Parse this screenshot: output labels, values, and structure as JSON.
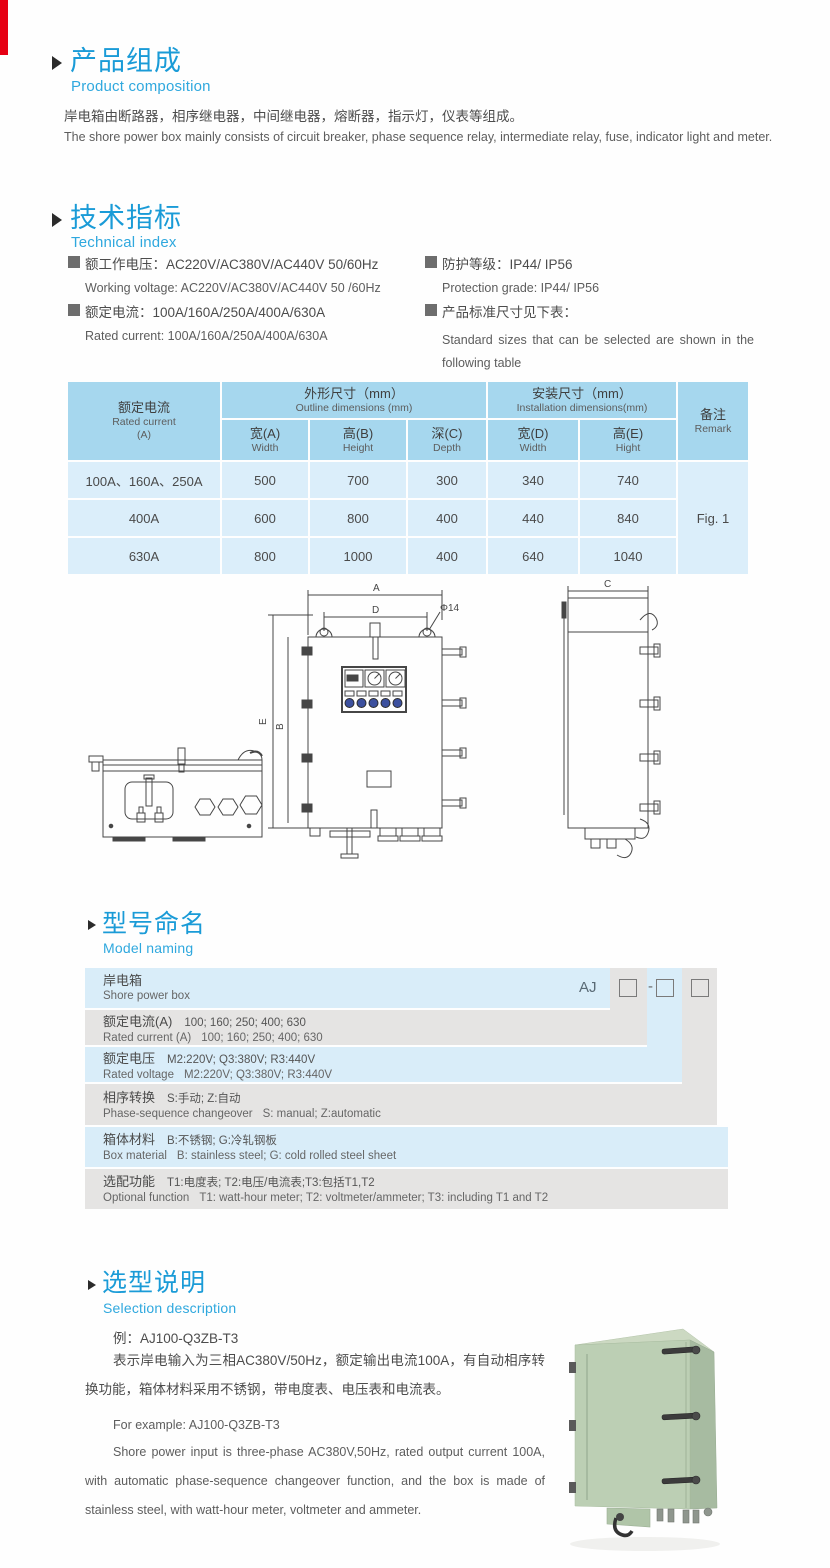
{
  "colors": {
    "accent_blue": "#1a9bd7",
    "subtitle_blue": "#2fa8de",
    "table_header_blue": "#a6d7ee",
    "table_row_blue": "#dbeefa",
    "naming_blue": "#d9edf9",
    "naming_gray": "#e5e4e3",
    "corner_mark_red": "#e60013",
    "lamp_blue": "#3c509e",
    "cabinet_green": "#bccfb4"
  },
  "product_composition": {
    "title_cn": "产品组成",
    "title_en": "Product composition",
    "body_cn": "岸电箱由断路器，相序继电器，中间继电器，熔断器，指示灯，仪表等组成。",
    "body_en": "The shore power box mainly consists of circuit breaker, phase sequence relay, intermediate relay, fuse, indicator light and meter."
  },
  "technical_index": {
    "title_cn": "技术指标",
    "title_en": "Technical index",
    "specs": [
      {
        "cn": "额工作电压：AC220V/AC380V/AC440V  50/60Hz",
        "en": "Working voltage: AC220V/AC380V/AC440V 50 /60Hz"
      },
      {
        "cn": "额定电流：100A/160A/250A/400A/630A",
        "en": "Rated current: 100A/160A/250A/400A/630A"
      },
      {
        "cn": "防护等级：IP44/ IP56",
        "en": "Protection grade: IP44/ IP56"
      },
      {
        "cn": "产品标准尺寸见下表：",
        "en": "Standard sizes that can be selected are shown in the following table"
      }
    ]
  },
  "dimensions_table": {
    "header": {
      "rated_current_cn": "额定电流",
      "rated_current_en": "Rated current",
      "rated_current_unit": "(A)",
      "outline_cn": "外形尺寸（mm）",
      "outline_en": "Outline dimensions (mm)",
      "install_cn": "安装尺寸（mm）",
      "install_en": "Installation dimensions(mm)",
      "cols": [
        {
          "cn": "宽(A)",
          "en": "Width"
        },
        {
          "cn": "高(B)",
          "en": "Height"
        },
        {
          "cn": "深(C)",
          "en": "Depth"
        },
        {
          "cn": "宽(D)",
          "en": "Width"
        },
        {
          "cn": "高(E)",
          "en": "Hight"
        }
      ],
      "remark_cn": "备注",
      "remark_en": "Remark"
    },
    "rows": [
      {
        "current": "100A、160A、250A",
        "values": [
          "500",
          "700",
          "300",
          "340",
          "740"
        ]
      },
      {
        "current": "400A",
        "values": [
          "600",
          "800",
          "400",
          "440",
          "840"
        ]
      },
      {
        "current": "630A",
        "values": [
          "800",
          "1000",
          "400",
          "640",
          "1040"
        ]
      }
    ],
    "remark_value": "Fig. 1"
  },
  "drawing": {
    "labels": {
      "a": "A",
      "d": "D",
      "phi": "Φ14",
      "b": "B",
      "e": "E",
      "c": "C"
    }
  },
  "model_naming": {
    "title_cn": "型号命名",
    "title_en": "Model naming",
    "prefix": "AJ",
    "dash": "-",
    "rows": [
      {
        "label_cn": "岸电箱",
        "opts_cn": "",
        "label_en": "Shore power box",
        "opts_en": ""
      },
      {
        "label_cn": "额定电流(A)",
        "opts_cn": "100; 160; 250; 400; 630",
        "label_en": "Rated current (A)",
        "opts_en": "100; 160; 250; 400; 630"
      },
      {
        "label_cn": "额定电压",
        "opts_cn": "M2:220V;  Q3:380V;  R3:440V",
        "label_en": "Rated voltage",
        "opts_en": "M2:220V;  Q3:380V;  R3:440V"
      },
      {
        "label_cn": "相序转换",
        "opts_cn": "S:手动; Z:自动",
        "label_en": "Phase-sequence changeover",
        "opts_en": "S: manual;  Z:automatic"
      },
      {
        "label_cn": "箱体材料",
        "opts_cn": "B:不锈钢;  G:冷轧钢板",
        "label_en": "Box material",
        "opts_en": "B: stainless steel; G: cold rolled steel sheet"
      },
      {
        "label_cn": "选配功能",
        "opts_cn": "T1:电度表;  T2:电压/电流表;T3:包括T1,T2",
        "label_en": "Optional function",
        "opts_en": "T1: watt-hour meter; T2: voltmeter/ammeter; T3: including T1 and T2"
      }
    ]
  },
  "selection": {
    "title_cn": "选型说明",
    "title_en": "Selection description",
    "example_cn": "例：AJ100-Q3ZB-T3",
    "desc_cn": "表示岸电输入为三相AC380V/50Hz，额定输出电流100A，有自动相序转换功能，箱体材料采用不锈钢，带电度表、电压表和电流表。",
    "example_en": "For example: AJ100-Q3ZB-T3",
    "desc_en": "Shore power input is three-phase AC380V,50Hz, rated output current 100A, with automatic phase-sequence changeover function, and the box is made of stainless steel, with watt-hour meter, voltmeter and ammeter."
  }
}
